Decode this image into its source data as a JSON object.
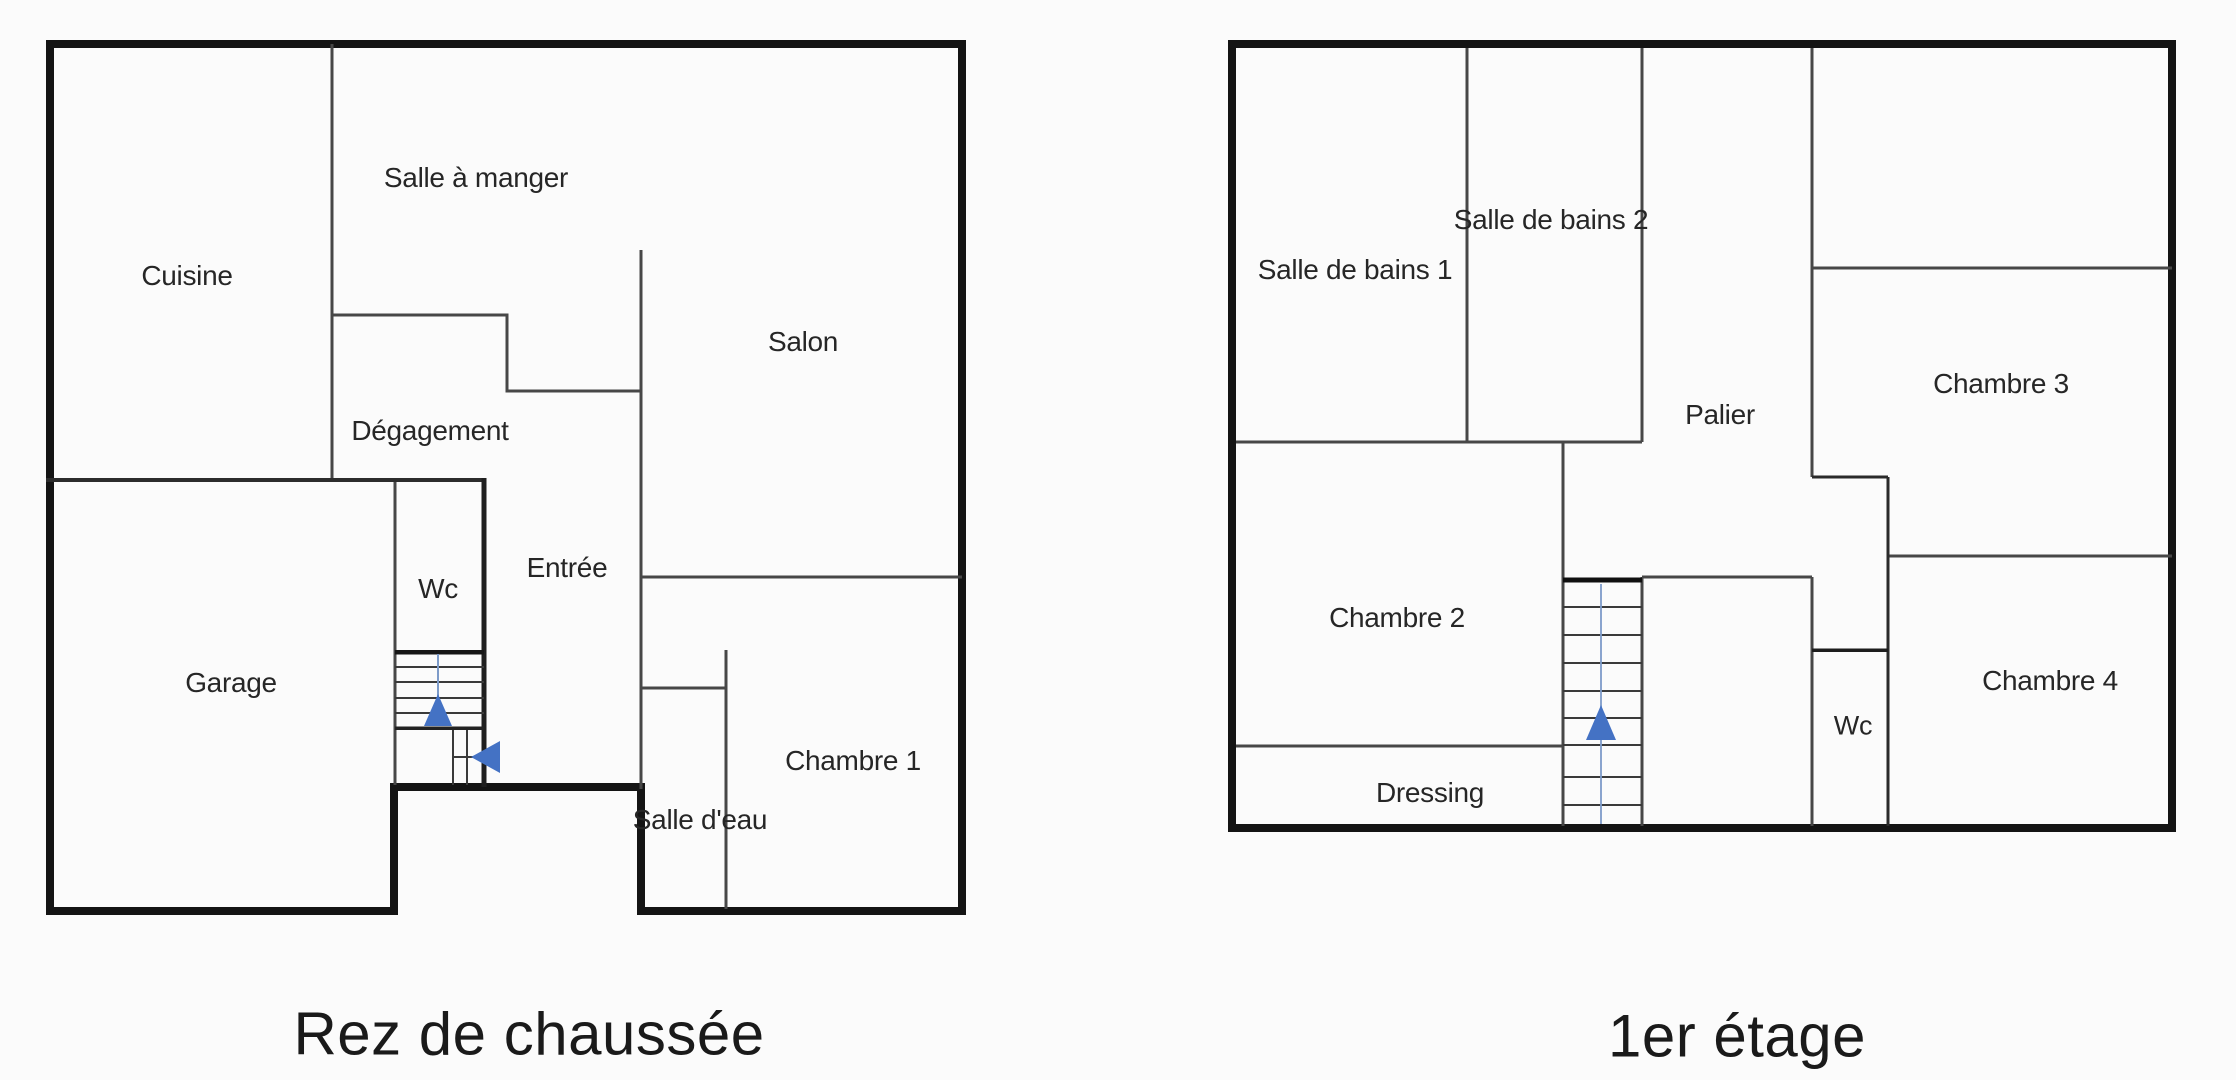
{
  "colors": {
    "background": "#fbfbfb",
    "outer_wall": "#141414",
    "inner_wall": "#474747",
    "stair_tread": "#3a3a3a",
    "stair_arrow_blue": "#4472c4",
    "stair_guide_blue": "#7d9bc9",
    "label_text": "#262626",
    "title_text": "#1a1a1a"
  },
  "ground_floor": {
    "title": "Rez de chaussée",
    "rooms": {
      "salle_a_manger": "Salle à manger",
      "cuisine": "Cuisine",
      "salon": "Salon",
      "degagement": "Dégagement",
      "wc": "Wc",
      "entree": "Entrée",
      "garage": "Garage",
      "chambre_1": "Chambre 1",
      "salle_d_eau": "Salle d'eau"
    }
  },
  "first_floor": {
    "title": "1er étage",
    "rooms": {
      "salle_de_bains_1": "Salle de bains 1",
      "salle_de_bains_2": "Salle de bains 2",
      "palier": "Palier",
      "chambre_2": "Chambre 2",
      "chambre_3": "Chambre 3",
      "chambre_4": "Chambre 4",
      "wc": "Wc",
      "dressing": "Dressing"
    }
  }
}
